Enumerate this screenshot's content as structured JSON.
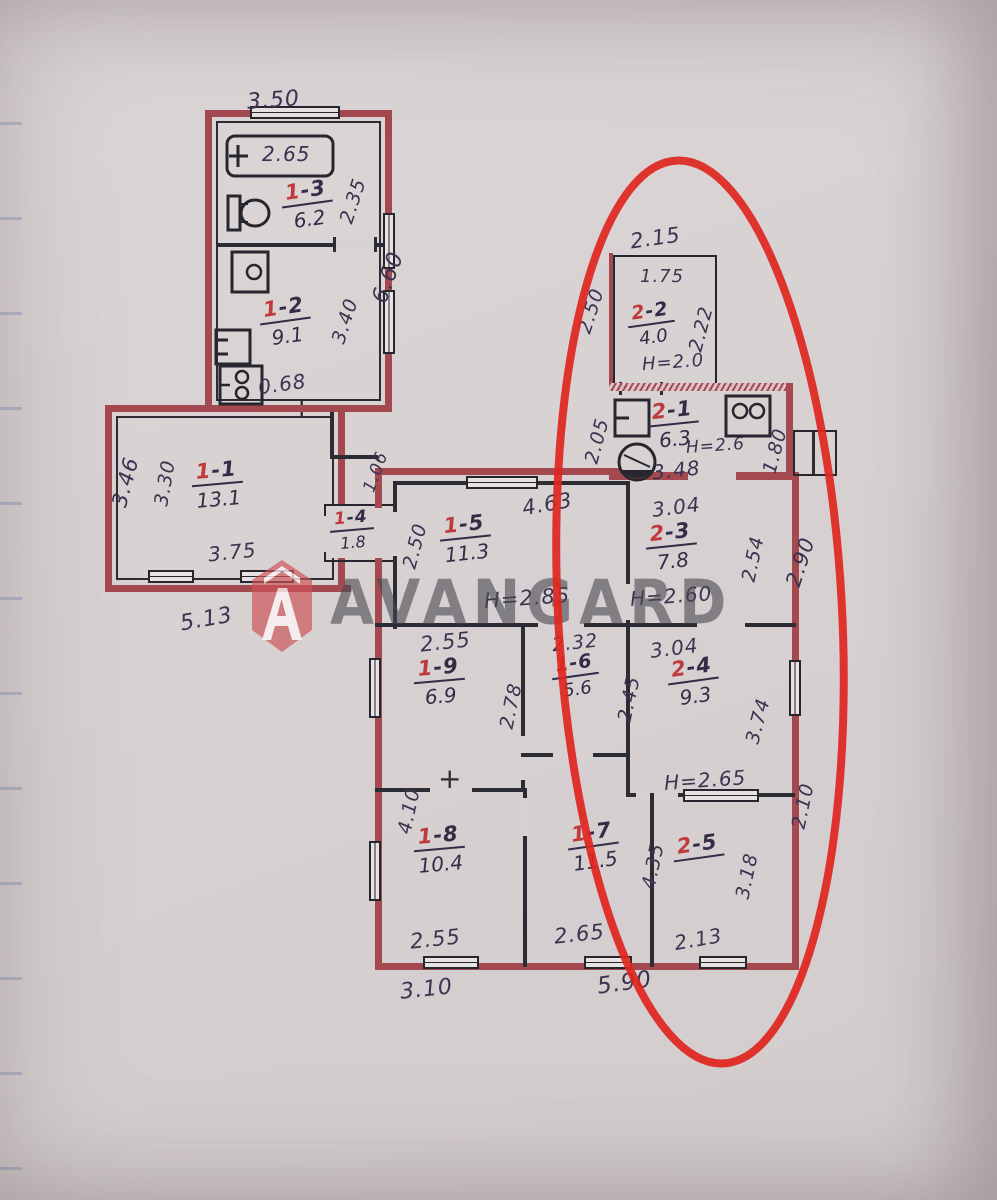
{
  "watermark": {
    "text": "AVANGARD"
  },
  "colors": {
    "paper": "#d7d1d2",
    "wall_red": "#a4494f",
    "ink": "#3a3450",
    "room_red": "#c03a3c",
    "ellipse_red": "#e02520",
    "watermark_gray": "#484850",
    "logo_red": "#cc5257"
  },
  "icons": {
    "bathtub": "bathtub-icon",
    "toilet": "toilet-icon",
    "sink": "sink-icon",
    "washbasin": "washbasin-icon",
    "stove": "stove-icon",
    "boiler": "boiler-icon"
  },
  "rooms": [
    {
      "prefix": "1",
      "suffix": "-3",
      "area": "6.2"
    },
    {
      "prefix": "1",
      "suffix": "-2",
      "area": "9.1"
    },
    {
      "prefix": "1",
      "suffix": "-1",
      "area": "13.1"
    },
    {
      "prefix": "1",
      "suffix": "-4",
      "area": "1.8"
    },
    {
      "prefix": "1",
      "suffix": "-5",
      "area": "11.3"
    },
    {
      "prefix": "2",
      "suffix": "-2",
      "area": "4.0"
    },
    {
      "prefix": "2",
      "suffix": "-1",
      "area": "6.3"
    },
    {
      "prefix": "2",
      "suffix": "-3",
      "area": "7.8"
    },
    {
      "prefix": "1",
      "suffix": "-9",
      "area": "6.9"
    },
    {
      "prefix": "1",
      "suffix": "-6",
      "area": "5.6"
    },
    {
      "prefix": "2",
      "suffix": "-4",
      "area": "9.3"
    },
    {
      "prefix": "1",
      "suffix": "-8",
      "area": "10.4"
    },
    {
      "prefix": "1",
      "suffix": "-7",
      "area": "11.5"
    },
    {
      "prefix": "2",
      "suffix": "-5",
      "area": ""
    }
  ],
  "heights": {
    "r22": "H=2.0",
    "r21": "H=2.6",
    "r15": "H=2.85",
    "r23": "H=2.60",
    "r24": "H=2.65"
  },
  "dims": {
    "a_top": "3.50",
    "a_bath": "2.65",
    "a_r13_side": "2.35",
    "a_right": "6.60",
    "a_r12_side": "3.40",
    "a_r12_bottom": "0.68",
    "b_left_out": "3.46",
    "b_left_in": "3.30",
    "b_bottom_in": "3.75",
    "b_bottom_out": "5.13",
    "conn_diag": "1.06",
    "c22_top": "2.15",
    "c_bath": "1.75",
    "r22_left_up": "2.50",
    "r22_left_dn": "2.05",
    "r22_right": "2.22",
    "r21_bottom": "3.48",
    "r21_right": "1.80",
    "r15_top": "4.63",
    "r15_left": "2.50",
    "r23_top": "3.04",
    "r23_right": "2.54",
    "right_upper": "2.90",
    "r19_top": "2.55",
    "mid_depth": "2.78",
    "r16_top": "2.32",
    "r16_right": "2.45",
    "r24_top": "3.04",
    "r24_right": "3.74",
    "r18_left": "4.10",
    "r18_bottom": "2.55",
    "r17_bottom": "2.65",
    "r17_right": "4.35",
    "r25_bottom": "2.13",
    "r25_right": "3.18",
    "right_lower": "2.10",
    "bottom_left": "3.10",
    "bottom_right": "5.90"
  }
}
